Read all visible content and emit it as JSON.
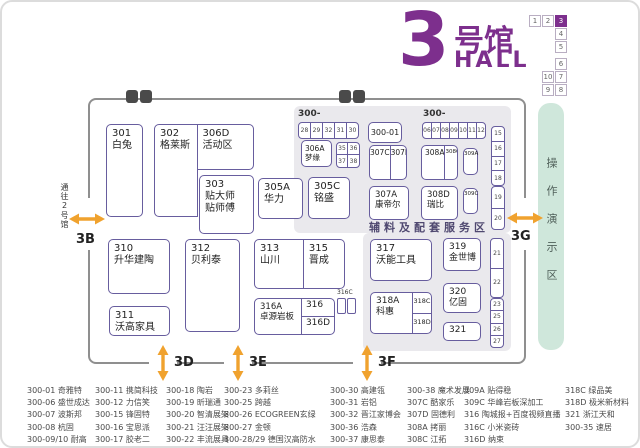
{
  "colors": {
    "brand_purple": "#7d2f8d",
    "arrow_orange": "#f0a22e",
    "demo_green": "#cfe7db",
    "panel_gray": "#eae9ed",
    "booth_border": "#675d9e"
  },
  "header": {
    "hall_number": "3",
    "hall_name": "号馆",
    "hall_word": "HALL",
    "minimap": {
      "active": "3",
      "cells": [
        {
          "label": "1",
          "col": 0,
          "row": 0
        },
        {
          "label": "2",
          "col": 1,
          "row": 0
        },
        {
          "label": "3",
          "col": 2,
          "row": 0,
          "active": true
        },
        {
          "label": "4",
          "col": 2,
          "row": 1
        },
        {
          "label": "5",
          "col": 2,
          "row": 2
        },
        {
          "label": "6",
          "col": 2,
          "row": 3.3
        },
        {
          "label": "10",
          "col": 1,
          "row": 4.3
        },
        {
          "label": "7",
          "col": 2,
          "row": 4.3
        },
        {
          "label": "9",
          "col": 1,
          "row": 5.3
        },
        {
          "label": "8",
          "col": 2,
          "row": 5.3
        }
      ]
    }
  },
  "plan": {
    "to_hall2_label": "通往2号馆",
    "demo_area_label": "操作演示区",
    "service_area_label": "辅料及配套服务区",
    "entrances": {
      "b": "3B",
      "d": "3D",
      "e": "3E",
      "f": "3F",
      "g": "3G"
    },
    "strips": {
      "s300a_label": "300-",
      "s300a": [
        "28",
        "29",
        "32",
        "31",
        "30"
      ],
      "s300b_label": "300-",
      "s300b": [
        "06",
        "07",
        "08",
        "09",
        "10",
        "11",
        "12"
      ],
      "s3536": [
        "35",
        "36",
        "37",
        "38"
      ],
      "right1": [
        "15",
        "16",
        "17",
        "18"
      ],
      "right2": [
        "19",
        "20"
      ],
      "right3": [
        "21",
        "22"
      ],
      "right4": [
        "23",
        "25",
        "26",
        "27"
      ]
    },
    "booths": {
      "300-01": {
        "id": "300-01"
      },
      "301": {
        "id": "301",
        "name": "白兔"
      },
      "302": {
        "id": "302",
        "name": "格莱斯"
      },
      "306D": {
        "id": "306D",
        "name": "活动区"
      },
      "303": {
        "id": "303",
        "name": "贴大师",
        "name2": "贴师傅"
      },
      "305A": {
        "id": "305A",
        "name": "华力"
      },
      "305C": {
        "id": "305C",
        "name": "铭盛"
      },
      "306A": {
        "id": "306A",
        "name": "梦缘"
      },
      "307C": {
        "id": "307C"
      },
      "307D": {
        "id": "307D"
      },
      "308A": {
        "id": "308A"
      },
      "308C": {
        "id": "308C"
      },
      "309A": {
        "id": "309A"
      },
      "307A": {
        "id": "307A",
        "name": "康帝尔"
      },
      "308D": {
        "id": "308D",
        "name": "瑞比"
      },
      "309C": {
        "id": "309C"
      },
      "310": {
        "id": "310",
        "name": "升华建陶"
      },
      "311": {
        "id": "311",
        "name": "沃高家具"
      },
      "312": {
        "id": "312",
        "name": "贝利泰"
      },
      "313": {
        "id": "313",
        "name": "山川"
      },
      "315": {
        "id": "315",
        "name": "晋成"
      },
      "316A": {
        "id": "316A",
        "name": "卓源岩板"
      },
      "316": {
        "id": "316"
      },
      "316D": {
        "id": "316D"
      },
      "316C": {
        "id": "316C"
      },
      "317": {
        "id": "317",
        "name": "沃能工具"
      },
      "318A": {
        "id": "318A",
        "name": "科惠"
      },
      "318C": {
        "id": "318C"
      },
      "318D": {
        "id": "318D"
      },
      "319": {
        "id": "319",
        "name": "金世博"
      },
      "320": {
        "id": "320",
        "name": "亿固"
      },
      "321": {
        "id": "321"
      }
    }
  },
  "legend": {
    "columns": [
      [
        "300-01 奇雅特",
        "300-06 盛世成达",
        "300-07 波斯邦",
        "300-08 杭固",
        "300-09/10 耐高"
      ],
      [
        "300-11 携简科技",
        "300-12 力信笑",
        "300-15 锋固特",
        "300-16 宝恩派",
        "300-17 胶老二"
      ],
      [
        "300-18 陶岩",
        "300-19 昕瑞通",
        "300-20 智清展架",
        "300-21 汪汪展架",
        "300-22 丰流展具"
      ],
      [
        "300-23 多莉丝",
        "300-25 跨越",
        "300-26 ECOGREEN玄绿",
        "300-27 金顿",
        "300-28/29 德国汉高防水"
      ],
      [
        "300-30 高建瓴",
        "300-31 岩铝",
        "300-32 晋江家博会",
        "300-36 浩森",
        "300-37 康思泰"
      ],
      [
        "300-38 魔术发展",
        "307C 酷家乐",
        "307D 固德利",
        "308A 拷丽",
        "308C 江拓"
      ],
      [
        "309A 贴得稳",
        "309C 华峰岩板深加工",
        "316 陶城报+百度视频直播",
        "316C 小米瓷砖",
        "316D 纳束"
      ],
      [
        "318C 绿品美",
        "318D 极米新材料",
        "321 浙江天和",
        "300-35 速居"
      ]
    ]
  }
}
